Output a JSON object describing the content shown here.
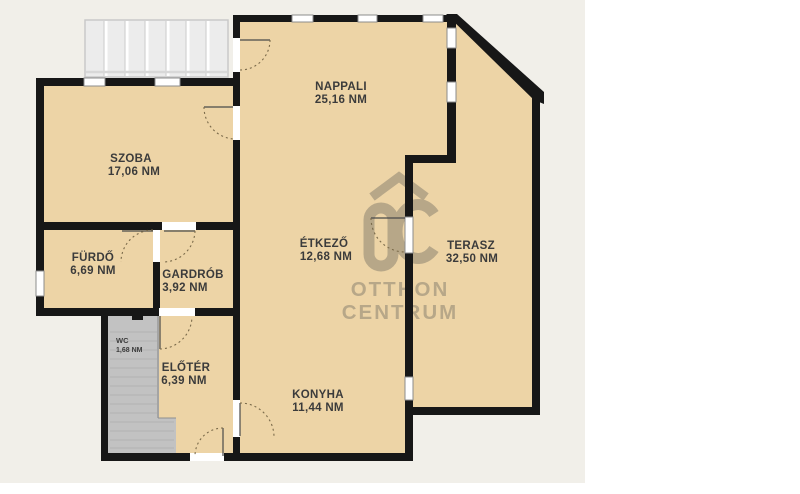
{
  "document": {
    "type": "floor-plan",
    "company_watermark": {
      "logo_letters": "OC",
      "line1": "OTTHON",
      "line2": "CENTRUM"
    }
  },
  "colors": {
    "page_background": "#ffffff",
    "canvas_background": "#f1efe9",
    "floor": "#edd4a6",
    "wall": "#171717",
    "interior_stairs": "#c2c2c2",
    "exterior_stairs": "#ececec",
    "watermark": "#b0a185",
    "label_text": "#3b3b3b"
  },
  "rooms": [
    {
      "id": "nappali",
      "name": "NAPPALI",
      "area": "25,16 NM"
    },
    {
      "id": "szoba",
      "name": "SZOBA",
      "area": "17,06 NM"
    },
    {
      "id": "furdo",
      "name": "FÜRDŐ",
      "area": "6,69 NM"
    },
    {
      "id": "gardrob",
      "name": "GARDRÓB",
      "area": "3,92 NM"
    },
    {
      "id": "etkezo",
      "name": "ÉTKEZŐ",
      "area": "12,68 NM"
    },
    {
      "id": "terasz",
      "name": "TERASZ",
      "area": "32,50 NM"
    },
    {
      "id": "wc",
      "name": "WC",
      "area": "1,68 NM"
    },
    {
      "id": "eloter",
      "name": "ELŐTÉR",
      "area": "6,39 NM"
    },
    {
      "id": "konyha",
      "name": "KONYHA",
      "area": "11,44 NM"
    }
  ]
}
